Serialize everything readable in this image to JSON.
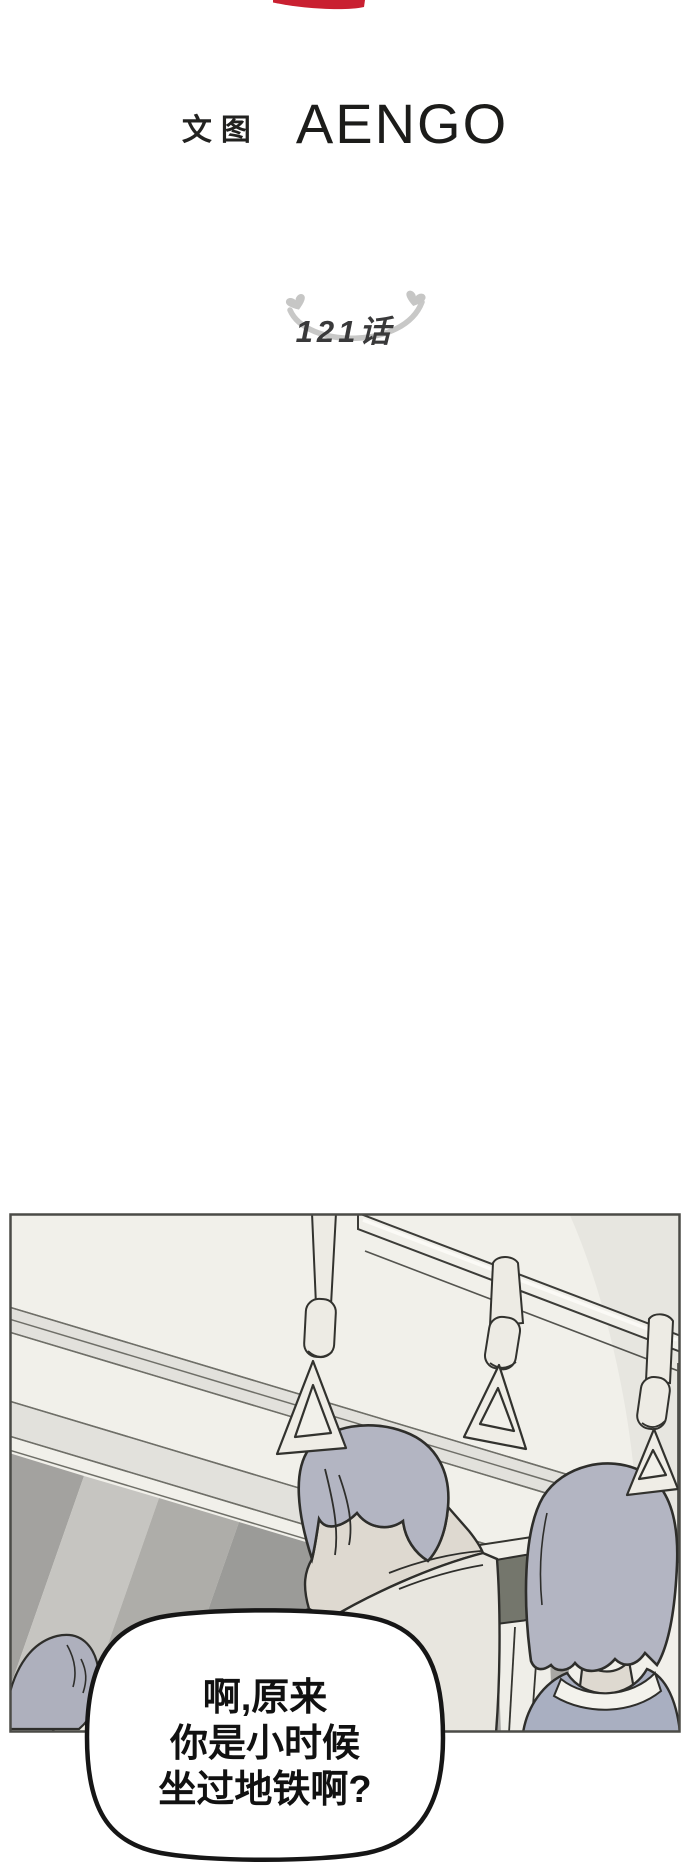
{
  "page": {
    "background_color": "#ffffff"
  },
  "header": {
    "brand_mark": "red-banner-tip",
    "brand_color": "#c92031",
    "credit_prefix": "文图",
    "author": "AENGO"
  },
  "episode": {
    "label": "121话",
    "decoration": "smile-arc-with-heart-tips",
    "decoration_color": "#c8c8c7"
  },
  "illustration": {
    "scene": "subway-car-interior-two-passengers-seen-from-behind-with-hanging-straps",
    "palette": {
      "panel_background": "#f1f0ea",
      "outline": "#34342f",
      "border": "#4b4b47",
      "hair_gray": "#b3b5c2",
      "skin": "#ded9d0",
      "shirt_cream": "#e8e6df",
      "jacket_blue_gray": "#a9afc1",
      "window_dark": "#74766c",
      "strap_cream": "#edebe4",
      "shadow_gray": "#9b9b98",
      "band_gray": "#e2e1dc"
    }
  },
  "speech_bubble": {
    "lines": [
      "啊,原来",
      "你是小时候",
      "坐过地铁啊?"
    ],
    "fill": "#ffffff",
    "border_color": "#161616"
  }
}
